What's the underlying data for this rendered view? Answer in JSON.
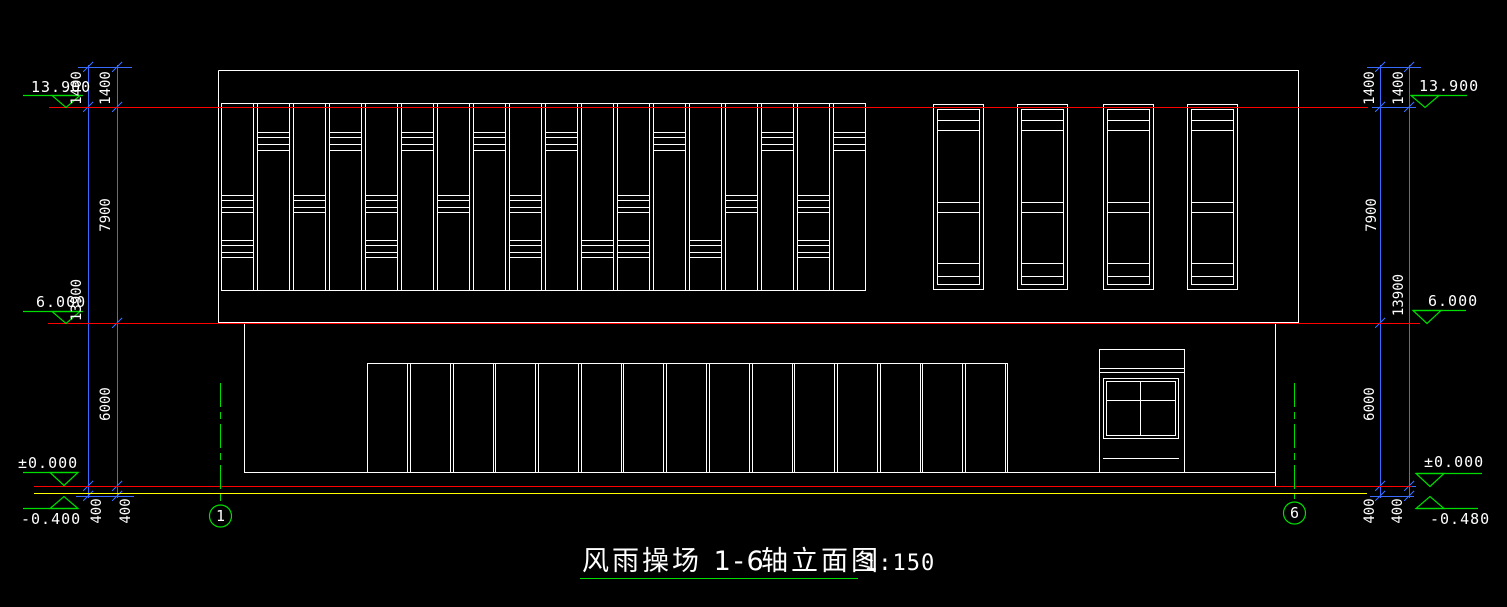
{
  "colors": {
    "background": "#000000",
    "line_white": "#ffffff",
    "datum_red": "#fd0000",
    "ground_yellow": "#ffff00",
    "annotation_green": "#00dd00",
    "dimension_blue": "#3a6bff",
    "text_white": "#ffffff"
  },
  "title": {
    "main": "风雨操场 1-6",
    "type": "轴立面图",
    "scale": "1:150"
  },
  "axis_markers": {
    "left": "1",
    "right": "6"
  },
  "elevation_markers": {
    "left": [
      "13.900",
      "6.000",
      "±0.000",
      "-0.400"
    ],
    "right": [
      "13.900",
      "6.000",
      "±0.000",
      "-0.480"
    ]
  },
  "dimensions": {
    "left": {
      "inner": [
        "1400",
        "7900",
        "6000",
        "400"
      ],
      "outer": [
        "1400",
        "13900",
        "400"
      ]
    },
    "right": {
      "inner": [
        "1400",
        "7900",
        "6000",
        "400"
      ],
      "outer": [
        "1400",
        "13900",
        "400"
      ]
    }
  }
}
